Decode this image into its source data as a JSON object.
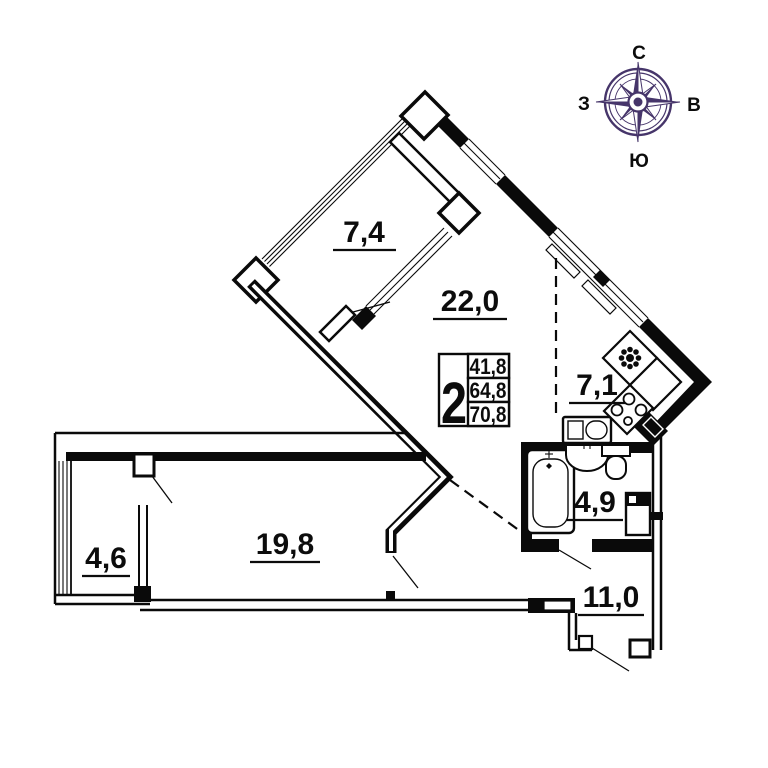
{
  "title": "Apartment floor plan",
  "compass": {
    "n": "С",
    "s": "Ю",
    "w": "З",
    "e": "В"
  },
  "summary": {
    "room_count": "2",
    "values": [
      "41,8",
      "64,8",
      "70,8"
    ]
  },
  "rooms": {
    "balcony_top": {
      "area": "7,4"
    },
    "living": {
      "area": "22,0"
    },
    "kitchen": {
      "area": "7,1"
    },
    "bath": {
      "area": "4,9"
    },
    "hall": {
      "area": "11,0"
    },
    "bedroom": {
      "area": "19,8"
    },
    "balcony_left": {
      "area": "4,6"
    }
  },
  "colors": {
    "walls": "#0a0a0a",
    "compass": "#46356a",
    "background": "#ffffff"
  },
  "icons": {
    "compass_rose": "compass-rose-icon",
    "kitchen_sink": "kitchen-sink-flower-icon",
    "stove": "stove-burners-icon"
  }
}
